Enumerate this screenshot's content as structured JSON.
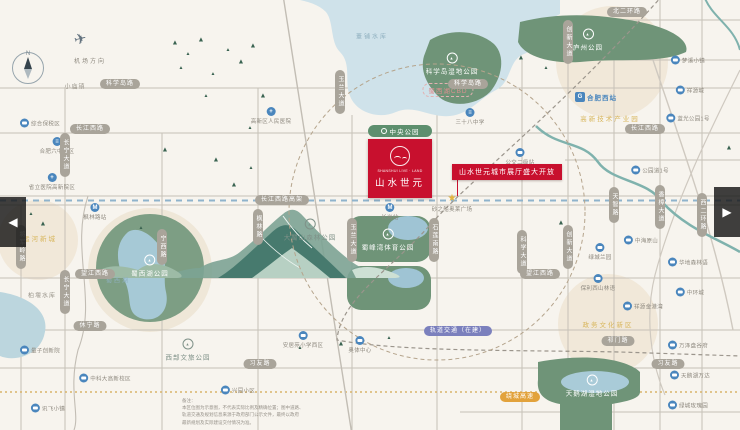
{
  "colors": {
    "accent_red": "#c8102e",
    "park_green": "#6f9478",
    "lake_blue": "#cfe2ea",
    "river_teal": "#7fb2ad",
    "road_gray": "#c6c1b7",
    "pill_gray": "#a9a49a",
    "icon_blue": "#4a86bd",
    "district_beige": "#f1e8d9",
    "metro_purple": "#7b80bd",
    "highway_orange": "#e2a23b",
    "park_pill_green": "#5d8f6e",
    "bg": "#f7f4ee"
  },
  "compass": {
    "north": "N"
  },
  "airport": {
    "label": "机场方向",
    "plane_glyph": "✈"
  },
  "carousel": {
    "prev": "◀",
    "next": "▶"
  },
  "project": {
    "en": "SHANSHUI LIVE · LAND",
    "cn": "山水世元",
    "park_tag": "中央公园",
    "banner": "山水世元城市展厅盛大开放"
  },
  "disclaimer": "备注：\n本区位图为示意图，不代表实际比例及精确位置；图中道路、\n轨道交通及规划信息来源于政府部门公示文件，最终以政府\n最新规划及实际建设交付情况为准。",
  "roads": {
    "h": [
      [
        88,
        0,
        740
      ],
      [
        133,
        0,
        740
      ],
      [
        196,
        0,
        740
      ],
      [
        205,
        0,
        740
      ],
      [
        278,
        0,
        740
      ],
      [
        330,
        0,
        740
      ],
      [
        368,
        0,
        740
      ],
      [
        20,
        470,
        740
      ],
      [
        60,
        555,
        740
      ],
      [
        160,
        565,
        740
      ],
      [
        412,
        460,
        740
      ]
    ],
    "v": [
      [
        65,
        88,
        430
      ],
      [
        162,
        133,
        430
      ],
      [
        258,
        88,
        430
      ],
      [
        352,
        115,
        430
      ],
      [
        437,
        115,
        430
      ],
      [
        522,
        60,
        430
      ],
      [
        568,
        20,
        430
      ],
      [
        614,
        60,
        430
      ],
      [
        660,
        0,
        430
      ],
      [
        702,
        0,
        430
      ],
      [
        21,
        205,
        430
      ]
    ]
  },
  "road_pills": [
    {
      "x": 120,
      "y": 84,
      "o": "h",
      "t": "科学岛路"
    },
    {
      "x": 468,
      "y": 84,
      "o": "h",
      "t": "科学岛路"
    },
    {
      "x": 90,
      "y": 129,
      "o": "h",
      "t": "长江西路"
    },
    {
      "x": 645,
      "y": 129,
      "o": "h",
      "t": "长江西路"
    },
    {
      "x": 282,
      "y": 200,
      "o": "h",
      "t": "长江西路高架"
    },
    {
      "x": 95,
      "y": 274,
      "o": "h",
      "t": "望江西路"
    },
    {
      "x": 540,
      "y": 274,
      "o": "h",
      "t": "望江西路"
    },
    {
      "x": 90,
      "y": 326,
      "o": "h",
      "t": "休宁路"
    },
    {
      "x": 618,
      "y": 341,
      "o": "h",
      "t": "祁门路"
    },
    {
      "x": 260,
      "y": 364,
      "o": "h",
      "t": "习友路"
    },
    {
      "x": 668,
      "y": 364,
      "o": "h",
      "t": "习友路"
    },
    {
      "x": 627,
      "y": 12,
      "o": "h",
      "t": "北二环路"
    },
    {
      "x": 458,
      "y": 331,
      "o": "h",
      "t": "轨道交通（在建）",
      "c": "purple"
    },
    {
      "x": 520,
      "y": 397,
      "o": "h",
      "t": "绕城高速",
      "c": "orange"
    },
    {
      "x": 65,
      "y": 155,
      "o": "v",
      "t": "长宁大道"
    },
    {
      "x": 65,
      "y": 292,
      "o": "v",
      "t": "长宁大道"
    },
    {
      "x": 21,
      "y": 247,
      "o": "v",
      "t": "将军岭路"
    },
    {
      "x": 162,
      "y": 247,
      "o": "v",
      "t": "宁西路"
    },
    {
      "x": 258,
      "y": 227,
      "o": "v",
      "t": "枫林路"
    },
    {
      "x": 340,
      "y": 92,
      "o": "v",
      "t": "玉兰大道"
    },
    {
      "x": 352,
      "y": 240,
      "o": "v",
      "t": "玉兰大道"
    },
    {
      "x": 434,
      "y": 240,
      "o": "v",
      "t": "石莲南路"
    },
    {
      "x": 522,
      "y": 252,
      "o": "v",
      "t": "科学大道"
    },
    {
      "x": 568,
      "y": 42,
      "o": "v",
      "t": "创新大道"
    },
    {
      "x": 568,
      "y": 247,
      "o": "v",
      "t": "创新大道"
    },
    {
      "x": 614,
      "y": 205,
      "o": "v",
      "t": "天智路"
    },
    {
      "x": 660,
      "y": 207,
      "o": "v",
      "t": "香樟大道"
    },
    {
      "x": 702,
      "y": 215,
      "o": "v",
      "t": "西二环路"
    }
  ],
  "pois": [
    {
      "x": 95,
      "y": 212,
      "ty": "metro",
      "t": "枫林路站",
      "p": "b"
    },
    {
      "x": 390,
      "y": 212,
      "ty": "metro",
      "t": "长岗站",
      "p": "b"
    },
    {
      "x": 596,
      "y": 97,
      "ty": "train",
      "t": "合肥西站",
      "p": "r",
      "lc": "blue"
    },
    {
      "x": 271,
      "y": 116,
      "ty": "hospital",
      "t": "高新区人民医院",
      "p": "b"
    },
    {
      "x": 52,
      "y": 182,
      "ty": "hospital",
      "t": "省立医院高新院区",
      "p": "b"
    },
    {
      "x": 57,
      "y": 146,
      "ty": "school",
      "t": "合肥六中西区",
      "p": "b"
    },
    {
      "x": 470,
      "y": 117,
      "ty": "school",
      "t": "三十八中学",
      "p": "b"
    },
    {
      "x": 452,
      "y": 203,
      "ty": "star",
      "t": "砂之船奥莱广场",
      "p": "b"
    },
    {
      "x": 40,
      "y": 123,
      "ty": "bus",
      "t": "综合保税区",
      "p": "r"
    },
    {
      "x": 688,
      "y": 60,
      "ty": "bus",
      "t": "梦溪小镇",
      "p": "r"
    },
    {
      "x": 690,
      "y": 90,
      "ty": "bus",
      "t": "祥源城",
      "p": "r"
    },
    {
      "x": 688,
      "y": 118,
      "ty": "bus",
      "t": "蓝光公园1号",
      "p": "r"
    },
    {
      "x": 650,
      "y": 170,
      "ty": "bus",
      "t": "公园道1号",
      "p": "r"
    },
    {
      "x": 641,
      "y": 240,
      "ty": "bus",
      "t": "中海原山",
      "p": "r"
    },
    {
      "x": 600,
      "y": 252,
      "ty": "bus",
      "t": "绿城兰园",
      "p": "b"
    },
    {
      "x": 598,
      "y": 283,
      "ty": "bus",
      "t": "保利西山林语",
      "p": "b"
    },
    {
      "x": 643,
      "y": 306,
      "ty": "bus",
      "t": "祥源金港湾",
      "p": "r"
    },
    {
      "x": 688,
      "y": 262,
      "ty": "bus",
      "t": "华地森林语",
      "p": "r"
    },
    {
      "x": 690,
      "y": 292,
      "ty": "bus",
      "t": "中环城",
      "p": "r"
    },
    {
      "x": 688,
      "y": 345,
      "ty": "bus",
      "t": "万泽盘谷府",
      "p": "r"
    },
    {
      "x": 690,
      "y": 375,
      "ty": "bus",
      "t": "天鹅湖万达",
      "p": "r"
    },
    {
      "x": 688,
      "y": 405,
      "ty": "bus",
      "t": "绿城玫瑰园",
      "p": "r"
    },
    {
      "x": 303,
      "y": 340,
      "ty": "bus",
      "t": "安居苑小学西区",
      "p": "b"
    },
    {
      "x": 360,
      "y": 345,
      "ty": "bus",
      "t": "奥体中心",
      "p": "b"
    },
    {
      "x": 105,
      "y": 378,
      "ty": "bus",
      "t": "中科大高新校区",
      "p": "r"
    },
    {
      "x": 40,
      "y": 350,
      "ty": "bus",
      "t": "量子创新院",
      "p": "r"
    },
    {
      "x": 48,
      "y": 408,
      "ty": "bus",
      "t": "讯飞小镇",
      "p": "r"
    },
    {
      "x": 238,
      "y": 390,
      "ty": "bus",
      "t": "兴园小区",
      "p": "r"
    },
    {
      "x": 520,
      "y": 157,
      "ty": "bus",
      "t": "公交二级站",
      "p": "b"
    }
  ],
  "park_labels": [
    {
      "x": 452,
      "y": 64,
      "t": "科学岛湿地公园",
      "v": "light"
    },
    {
      "x": 588,
      "y": 40,
      "t": "庐州公园",
      "v": "light"
    },
    {
      "x": 388,
      "y": 240,
      "t": "蜀峰湾体育公园",
      "v": "light"
    },
    {
      "x": 150,
      "y": 266,
      "t": "蜀西湖公园",
      "v": "light"
    },
    {
      "x": 592,
      "y": 386,
      "t": "天鹅湖湿地公园",
      "v": "light"
    },
    {
      "x": 310,
      "y": 230,
      "t": "大蜀山森林公园",
      "v": "dark"
    },
    {
      "x": 188,
      "y": 350,
      "t": "西部文旅公园",
      "v": "dark"
    }
  ],
  "water_labels": [
    {
      "x": 372,
      "y": 36,
      "t": "董铺水库"
    },
    {
      "x": 118,
      "y": 280,
      "t": "蜀西湖"
    }
  ],
  "area_labels": [
    {
      "x": 610,
      "y": 118,
      "t": "高新技术产业园",
      "s": "yellow"
    },
    {
      "x": 608,
      "y": 324,
      "t": "政务文化新区",
      "s": "yellow"
    },
    {
      "x": 40,
      "y": 238,
      "t": "运河新城",
      "s": "yellow"
    },
    {
      "x": 448,
      "y": 90,
      "t": "蜀西湖CBD",
      "s": "pink"
    },
    {
      "x": 75,
      "y": 86,
      "t": "小庙镇",
      "s": "gray"
    },
    {
      "x": 42,
      "y": 295,
      "t": "柏堰水库",
      "s": "gray"
    }
  ],
  "trees": [
    [
      175,
      43
    ],
    [
      188,
      54
    ],
    [
      201,
      40
    ],
    [
      228,
      50
    ],
    [
      241,
      62
    ],
    [
      213,
      74
    ],
    [
      253,
      46
    ],
    [
      181,
      68
    ],
    [
      165,
      150
    ],
    [
      206,
      96
    ],
    [
      263,
      96
    ],
    [
      251,
      168
    ],
    [
      216,
      160
    ],
    [
      300,
      348
    ],
    [
      341,
      344
    ],
    [
      389,
      338
    ],
    [
      521,
      58
    ],
    [
      546,
      68
    ],
    [
      561,
      223
    ],
    [
      31,
      214
    ],
    [
      43,
      224
    ],
    [
      141,
      228
    ],
    [
      729,
      148
    ],
    [
      250,
      128
    ],
    [
      234,
      185
    ]
  ]
}
